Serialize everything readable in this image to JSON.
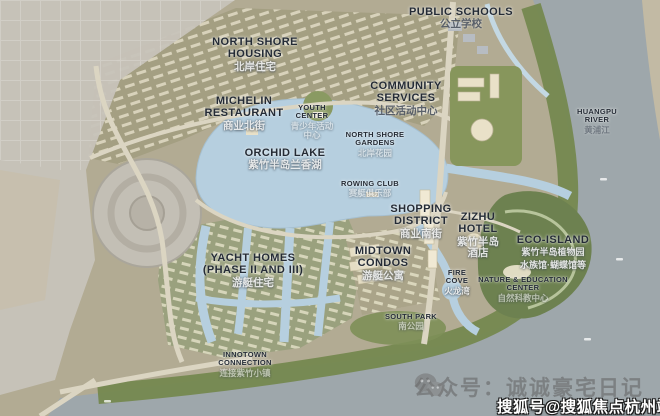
{
  "map": {
    "description": "Zizhu Peninsula masterplan rendering",
    "labels": [
      {
        "id": "public-schools",
        "en": "PUBLIC SCHOOLS",
        "cn": "公立学校"
      },
      {
        "id": "north-shore-housing",
        "en": "NORTH SHORE HOUSING",
        "cn": "北岸住宅"
      },
      {
        "id": "michelin-restaurant",
        "en": "MICHELIN RESTAURANT",
        "cn": "商业北街"
      },
      {
        "id": "community-services",
        "en": "COMMUNITY SERVICES",
        "cn": "社区活动中心"
      },
      {
        "id": "youth-center",
        "en": "YOUTH CENTER",
        "cn": "青少年活动中心"
      },
      {
        "id": "north-shore-gardens",
        "en": "NORTH SHORE GARDENS",
        "cn": "北岸花园"
      },
      {
        "id": "orchid-lake",
        "en": "ORCHID LAKE",
        "cn": "紫竹半岛兰香湖"
      },
      {
        "id": "huangpu-river",
        "en": "HUANGPU RIVER",
        "cn": "黄浦江"
      },
      {
        "id": "rowing-club",
        "en": "ROWING CLUB",
        "cn": "赛艇俱乐部"
      },
      {
        "id": "shopping-district",
        "en": "SHOPPING DISTRICT",
        "cn": "商业南街"
      },
      {
        "id": "zizhu-hotel",
        "en": "ZIZHU HOTEL",
        "cn": "紫竹半岛酒店"
      },
      {
        "id": "eco-island",
        "en": "ECO-ISLAND",
        "cn": "紫竹半岛植物园",
        "cn2": "水族馆·蝴蝶馆等"
      },
      {
        "id": "yacht-homes",
        "en": "YACHT HOMES (PHASE II AND III)",
        "cn": "游艇住宅"
      },
      {
        "id": "midtown-condos",
        "en": "MIDTOWN CONDOS",
        "cn": "游艇公寓"
      },
      {
        "id": "fire-cove",
        "en": "FIRE COVE",
        "cn": "火龙湾"
      },
      {
        "id": "nature-education-center",
        "en": "NATURE & EDUCATION CENTER",
        "cn": "自然科教中心"
      },
      {
        "id": "south-park",
        "en": "SOUTH PARK",
        "cn": "南公园"
      },
      {
        "id": "innotown-connection",
        "en": "INNOTOWN CONNECTION",
        "cn": "连接紫竹小镇"
      }
    ],
    "colors": {
      "land": "#b2ab93",
      "river": "#9ea7ab",
      "lake": "#b6cfdf",
      "park_green": "#75884f",
      "label_text": "#242b35"
    }
  },
  "watermarks": {
    "wechat_icon": "wechat-icon",
    "wechat_text": "公众号：诚诚豪宅日记",
    "sohu_text": "搜狐号@搜狐焦点杭州站"
  }
}
